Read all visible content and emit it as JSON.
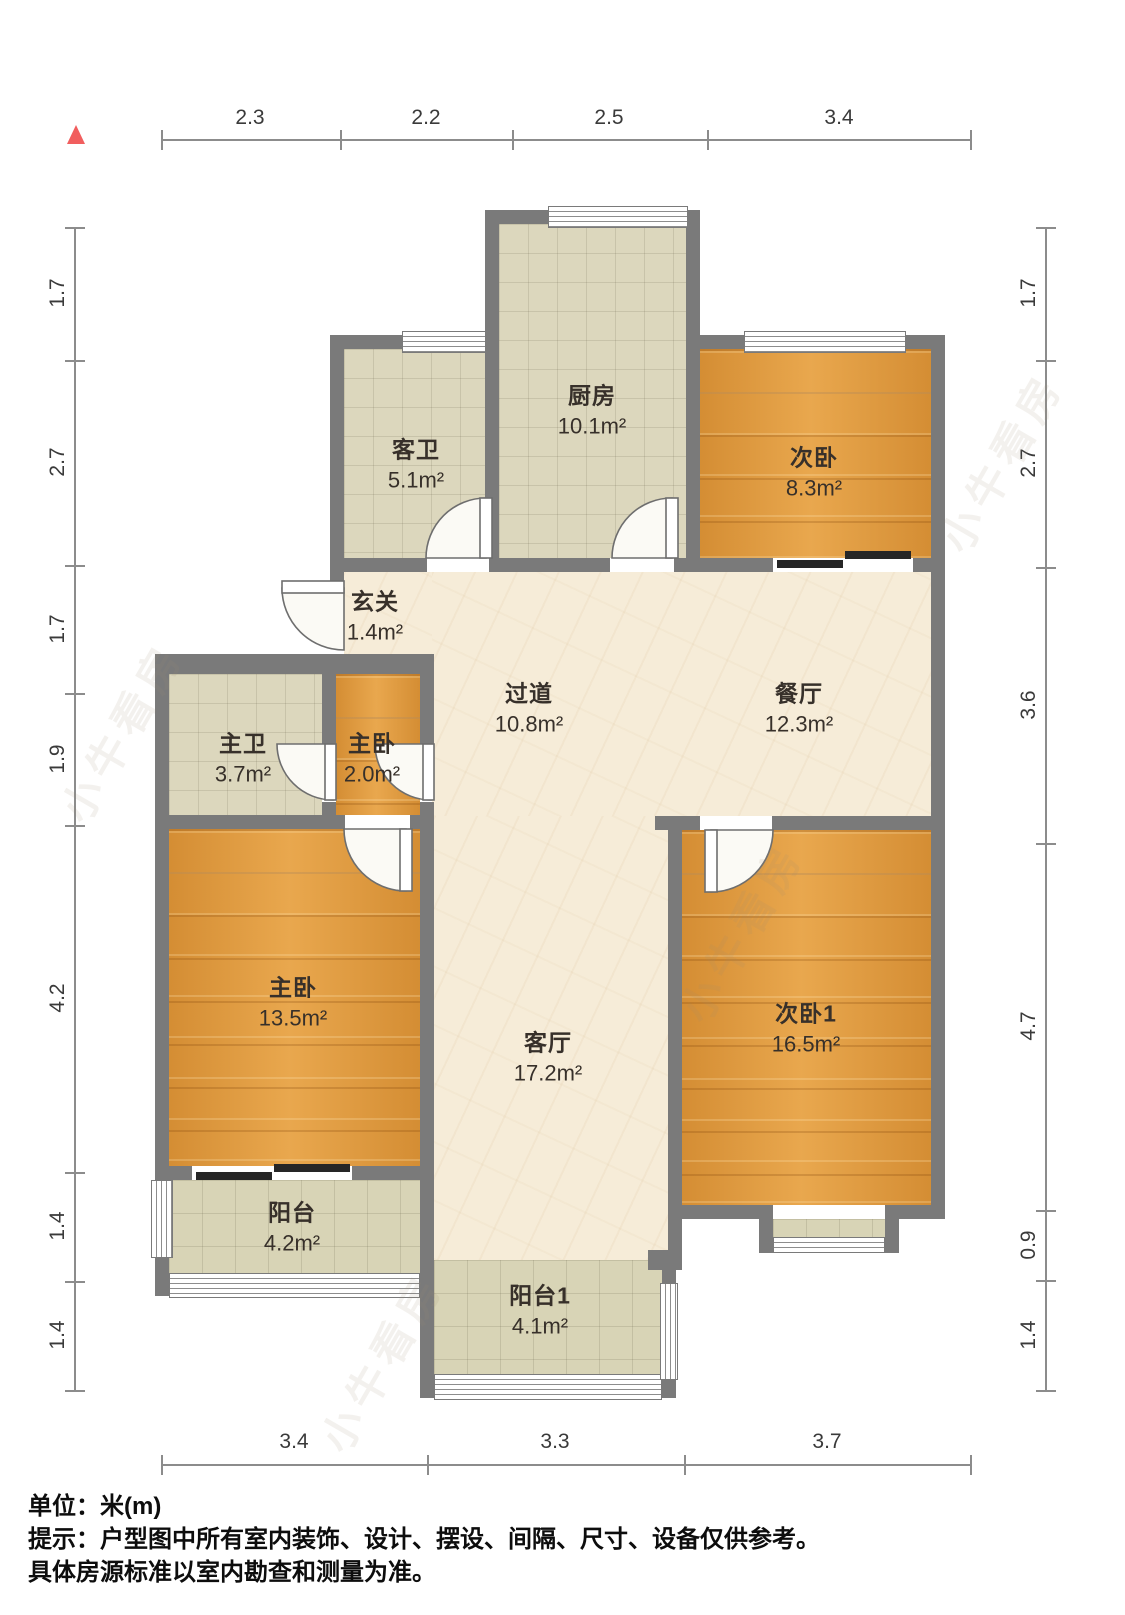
{
  "compass": {
    "symbol": "north-triangle",
    "color": "#f15e5e"
  },
  "dimensions": {
    "top": [
      "2.3",
      "2.2",
      "2.5",
      "3.4"
    ],
    "bottom": [
      "3.4",
      "3.3",
      "3.7"
    ],
    "left": [
      "1.7",
      "2.7",
      "1.7",
      "1.9",
      "4.2",
      "1.4",
      "1.4"
    ],
    "right": [
      "1.7",
      "2.7",
      "3.6",
      "4.7",
      "0.9",
      "1.4"
    ]
  },
  "rooms": [
    {
      "name": "厨房",
      "area": "10.1m²"
    },
    {
      "name": "客卫",
      "area": "5.1m²"
    },
    {
      "name": "次卧",
      "area": "8.3m²"
    },
    {
      "name": "玄关",
      "area": "1.4m²"
    },
    {
      "name": "过道",
      "area": "10.8m²"
    },
    {
      "name": "餐厅",
      "area": "12.3m²"
    },
    {
      "name": "主卫",
      "area": "3.7m²"
    },
    {
      "name": "主卧",
      "area": "2.0m²"
    },
    {
      "name": "主卧",
      "area": "13.5m²"
    },
    {
      "name": "客厅",
      "area": "17.2m²"
    },
    {
      "name": "次卧1",
      "area": "16.5m²"
    },
    {
      "name": "阳台",
      "area": "4.2m²"
    },
    {
      "name": "阳台1",
      "area": "4.1m²"
    }
  ],
  "watermark": "小牛看房",
  "footer": {
    "unit": "单位：米(m)",
    "line1": "提示：户型图中所有室内装饰、设计、摆设、间隔、尺寸、设备仅供参考。",
    "line2": "具体房源标准以室内勘查和测量为准。"
  },
  "colors": {
    "wall": "#7a7a7a",
    "wood": "#e49d3e",
    "tile": "#dcd7bd",
    "marble": "#f6ecd8",
    "accent": "#f15e5e"
  }
}
